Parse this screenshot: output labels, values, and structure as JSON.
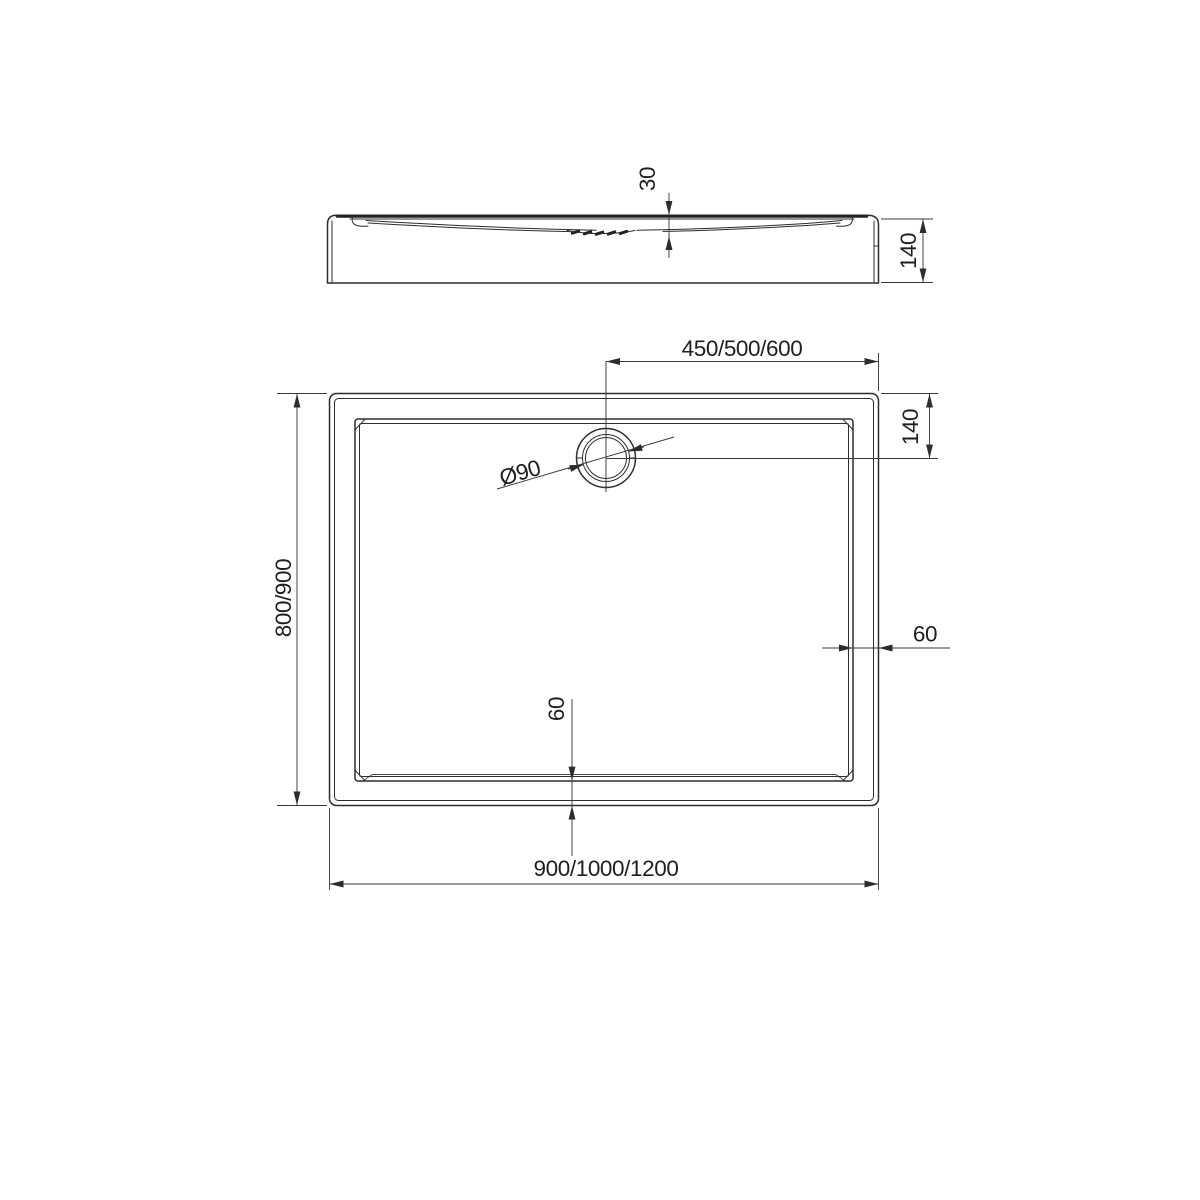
{
  "document": {
    "type": "technical-drawing",
    "subject": "rectangular shower tray with corner drain, two orthographic views",
    "background_color": "#ffffff",
    "line_color": "#2d2d2d"
  },
  "side_view": {
    "dimensions": {
      "basin_depth": "30",
      "total_height": "140"
    }
  },
  "plan_view": {
    "dimensions": {
      "drain_offset_horizontal": "450/500/600",
      "drain_offset_vertical": "140",
      "drain_diameter": "Ø90",
      "length_options": "800/900",
      "rim_width_right": "60",
      "rim_width_bottom": "60",
      "width_options": "900/1000/1200"
    }
  }
}
